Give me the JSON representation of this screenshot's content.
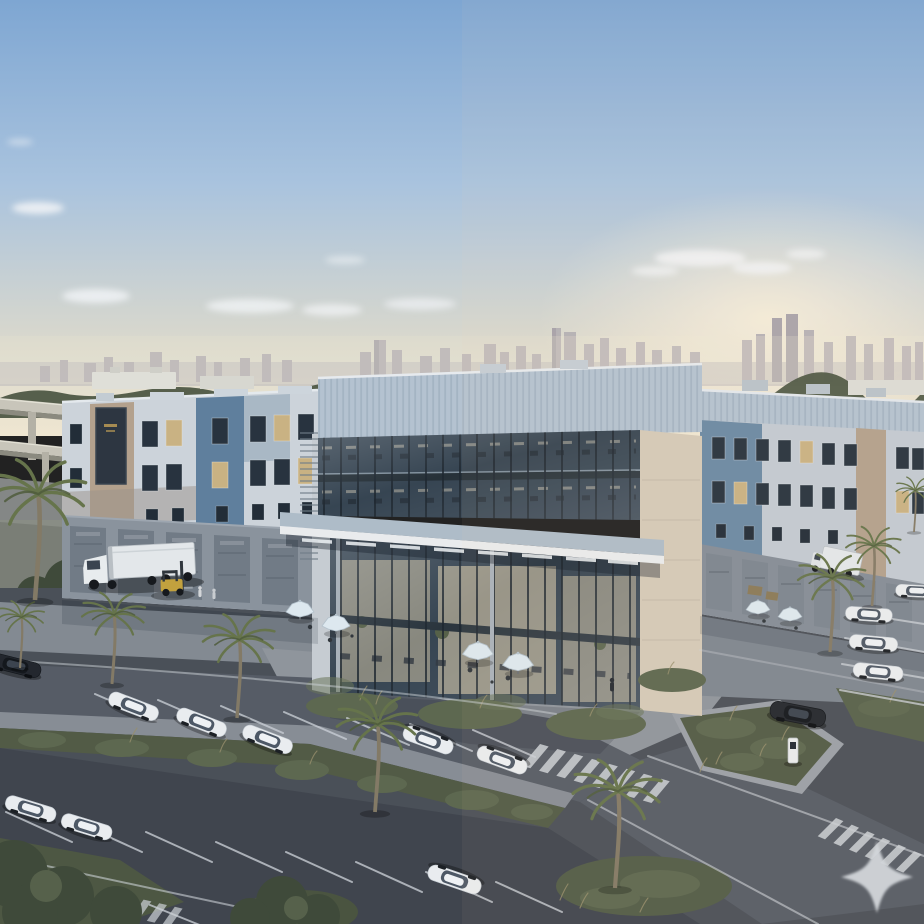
{
  "scene": {
    "description": "Aerial golden-hour rendering of a modern three-storey logistics and office complex with a glass corner atrium, loading docks with trucks and a forklift, palm-lined parking lot, outdoor cafe umbrellas, crosswalks and a hazy city skyline with highway overpasses.",
    "watermark": {
      "icon": "four-point-sparkle"
    }
  },
  "palette": {
    "sky_top": "#7ea6d2",
    "sky_mid": "#a9c3de",
    "sky_low": "#d9d8cd",
    "sky_horizon": "#efe6d1",
    "sun_glow": "#fff3dd",
    "cloud": "#f3f5f7",
    "skyline": "#b0acb3",
    "skyline_dark": "#a19da6",
    "treeline": "#4e5745",
    "distant_building": "#dfdfd8",
    "highway_concrete": "#c8c5ba",
    "cladding_light": "#ccd3da",
    "cladding_light2": "#c2cad2",
    "corrugated_band": "#b4c2d0",
    "corrugated_side": "#9cadbd",
    "cladding_blue": "#5f7f9d",
    "cladding_beige": "#b3a18d",
    "glass_dark": "#2e3d4b",
    "interior_warm": "#d8c9a8",
    "stone": "#d4cab8",
    "canopy_top": "#aebcc8",
    "canopy_fascia": "#e9ebed",
    "dock_wall": "#8a939d",
    "dock_wall_right": "#848d97",
    "dock_door": "#717b86",
    "asphalt": "#4a5058",
    "asphalt_dark": "#40454e",
    "road": "#565c66",
    "apron": "#838a92",
    "apron_right": "#7e8690",
    "plaza": "#8f959c",
    "sidewalk": "#878d95",
    "median_green": "#525b46",
    "shrub": "#5d6850",
    "tree_dark": "#3f4a3a",
    "palm_frond": "#66744b",
    "palm_trunk": "#837a66",
    "car_white": "#e9ecef",
    "car_dark": "#23272e",
    "truck_white": "#e3e7ea",
    "forklift_yellow": "#c2a13e",
    "umbrella": "#dde8ef",
    "watermark": "#d2d5d9"
  },
  "objects": {
    "white_cars": 12,
    "dark_cars": 2,
    "semi_trucks": 2,
    "forklifts": 1,
    "loading_docks_left_wing": 5,
    "loading_docks_right_wing": 6,
    "patio_umbrellas": 6,
    "palm_trees": 9,
    "crosswalks": 3,
    "ev_chargers": 1,
    "people": 3
  }
}
